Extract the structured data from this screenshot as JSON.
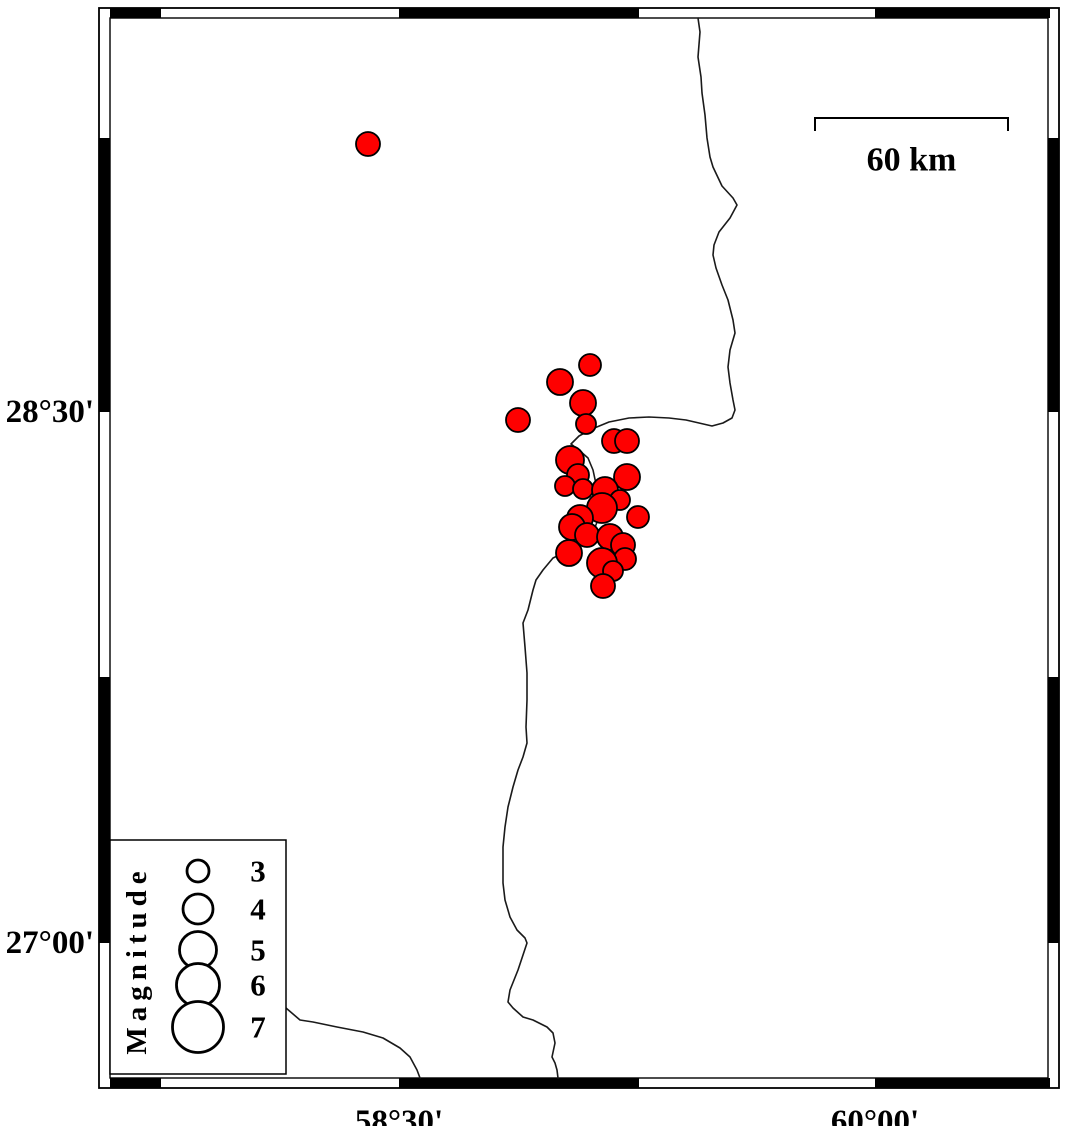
{
  "map": {
    "frame": {
      "outer": {
        "x1": 99,
        "y1": 8,
        "x2": 1059,
        "y2": 1088
      },
      "inner": {
        "x1": 110,
        "y1": 18,
        "x2": 1048,
        "y2": 1078
      },
      "black_segments_x": [
        [
          110,
          161
        ],
        [
          399,
          639
        ],
        [
          875,
          1050
        ]
      ],
      "black_segments_y": [
        [
          138,
          412
        ],
        [
          677,
          943
        ]
      ]
    },
    "axis": {
      "left_labels": [
        {
          "text": "28°30'",
          "y": 412
        },
        {
          "text": "27°00'",
          "y": 943
        }
      ],
      "bottom_labels": [
        {
          "text": "58°30'",
          "x": 399
        },
        {
          "text": "60°00'",
          "x": 875
        }
      ]
    },
    "scale_bar": {
      "label": "60 km",
      "x1": 815,
      "x2": 1008,
      "y": 118,
      "tick_drop": 13,
      "label_y": 160
    },
    "legend": {
      "title": "Magnitude",
      "box": {
        "x1": 110,
        "y1": 840,
        "x2": 286,
        "y2": 1074
      },
      "title_x": 137,
      "title_y": 960,
      "circle_x": 198,
      "label_x": 258,
      "entries": [
        {
          "label": "3",
          "y": 871,
          "r": 11
        },
        {
          "label": "4",
          "y": 909,
          "r": 15
        },
        {
          "label": "5",
          "y": 950,
          "r": 18.5
        },
        {
          "label": "6",
          "y": 985,
          "r": 21.5
        },
        {
          "label": "7",
          "y": 1027,
          "r": 25.5
        }
      ]
    },
    "events": [
      [
        368,
        144,
        12
      ],
      [
        518,
        420,
        12
      ],
      [
        560,
        382,
        13
      ],
      [
        590,
        365,
        11
      ],
      [
        583,
        403,
        13
      ],
      [
        586,
        424,
        10
      ],
      [
        614,
        441,
        12
      ],
      [
        627,
        441,
        12
      ],
      [
        570,
        460,
        14
      ],
      [
        578,
        475,
        11
      ],
      [
        627,
        477,
        13
      ],
      [
        565,
        486,
        10
      ],
      [
        583,
        489,
        10
      ],
      [
        605,
        490,
        13
      ],
      [
        620,
        500,
        10
      ],
      [
        602,
        508,
        15
      ],
      [
        638,
        517,
        11
      ],
      [
        580,
        518,
        13
      ],
      [
        572,
        527,
        13
      ],
      [
        587,
        535,
        12
      ],
      [
        610,
        537,
        13
      ],
      [
        623,
        545,
        12
      ],
      [
        569,
        553,
        13
      ],
      [
        625,
        559,
        11
      ],
      [
        602,
        563,
        15
      ],
      [
        613,
        571,
        10
      ],
      [
        603,
        586,
        12
      ]
    ],
    "coastline": {
      "main": [
        [
          698,
          18
        ],
        [
          700,
          32
        ],
        [
          698,
          57
        ],
        [
          701,
          77
        ],
        [
          702,
          93
        ],
        [
          705,
          115
        ],
        [
          707,
          138
        ],
        [
          710,
          157
        ],
        [
          713,
          167
        ],
        [
          722,
          186
        ],
        [
          733,
          198
        ],
        [
          737,
          205
        ],
        [
          730,
          218
        ],
        [
          719,
          232
        ],
        [
          714,
          245
        ],
        [
          713,
          255
        ],
        [
          716,
          268
        ],
        [
          722,
          285
        ],
        [
          728,
          300
        ],
        [
          733,
          320
        ],
        [
          735,
          333
        ],
        [
          730,
          350
        ],
        [
          728,
          367
        ],
        [
          730,
          383
        ],
        [
          733,
          400
        ],
        [
          735,
          410
        ],
        [
          732,
          418
        ],
        [
          723,
          423
        ],
        [
          712,
          426
        ],
        [
          699,
          423
        ],
        [
          686,
          420
        ],
        [
          669,
          418
        ],
        [
          649,
          417
        ],
        [
          629,
          418
        ],
        [
          609,
          422
        ],
        [
          592,
          429
        ],
        [
          579,
          436
        ],
        [
          571,
          444
        ],
        [
          580,
          451
        ],
        [
          588,
          458
        ],
        [
          593,
          470
        ],
        [
          596,
          484
        ],
        [
          600,
          500
        ],
        [
          600,
          515
        ],
        [
          593,
          532
        ],
        [
          580,
          545
        ],
        [
          566,
          552
        ],
        [
          553,
          558
        ],
        [
          543,
          570
        ],
        [
          536,
          580
        ],
        [
          533,
          590
        ],
        [
          528,
          610
        ],
        [
          523,
          623
        ],
        [
          525,
          647
        ],
        [
          527,
          673
        ],
        [
          527,
          700
        ],
        [
          526,
          727
        ],
        [
          527,
          743
        ],
        [
          523,
          757
        ],
        [
          518,
          770
        ],
        [
          513,
          787
        ],
        [
          508,
          807
        ],
        [
          505,
          827
        ],
        [
          503,
          847
        ],
        [
          503,
          867
        ],
        [
          503,
          883
        ],
        [
          505,
          900
        ],
        [
          510,
          917
        ],
        [
          517,
          930
        ],
        [
          525,
          938
        ],
        [
          527,
          943
        ],
        [
          522,
          958
        ],
        [
          518,
          970
        ],
        [
          510,
          990
        ],
        [
          508,
          1002
        ],
        [
          513,
          1008
        ],
        [
          523,
          1017
        ],
        [
          533,
          1020
        ],
        [
          547,
          1027
        ],
        [
          553,
          1033
        ],
        [
          555,
          1043
        ],
        [
          552,
          1057
        ],
        [
          555,
          1063
        ],
        [
          557,
          1070
        ],
        [
          558,
          1078
        ]
      ],
      "branch": [
        [
          286,
          1008
        ],
        [
          300,
          1020
        ],
        [
          313,
          1022
        ],
        [
          337,
          1027
        ],
        [
          363,
          1032
        ],
        [
          383,
          1038
        ],
        [
          400,
          1048
        ],
        [
          410,
          1057
        ],
        [
          417,
          1070
        ],
        [
          420,
          1078
        ]
      ]
    },
    "colors": {
      "event_fill": "#fe0000",
      "event_stroke": "#000000",
      "coastline": "#1a1a1a",
      "frame": "#000000",
      "background": "#ffffff"
    }
  }
}
